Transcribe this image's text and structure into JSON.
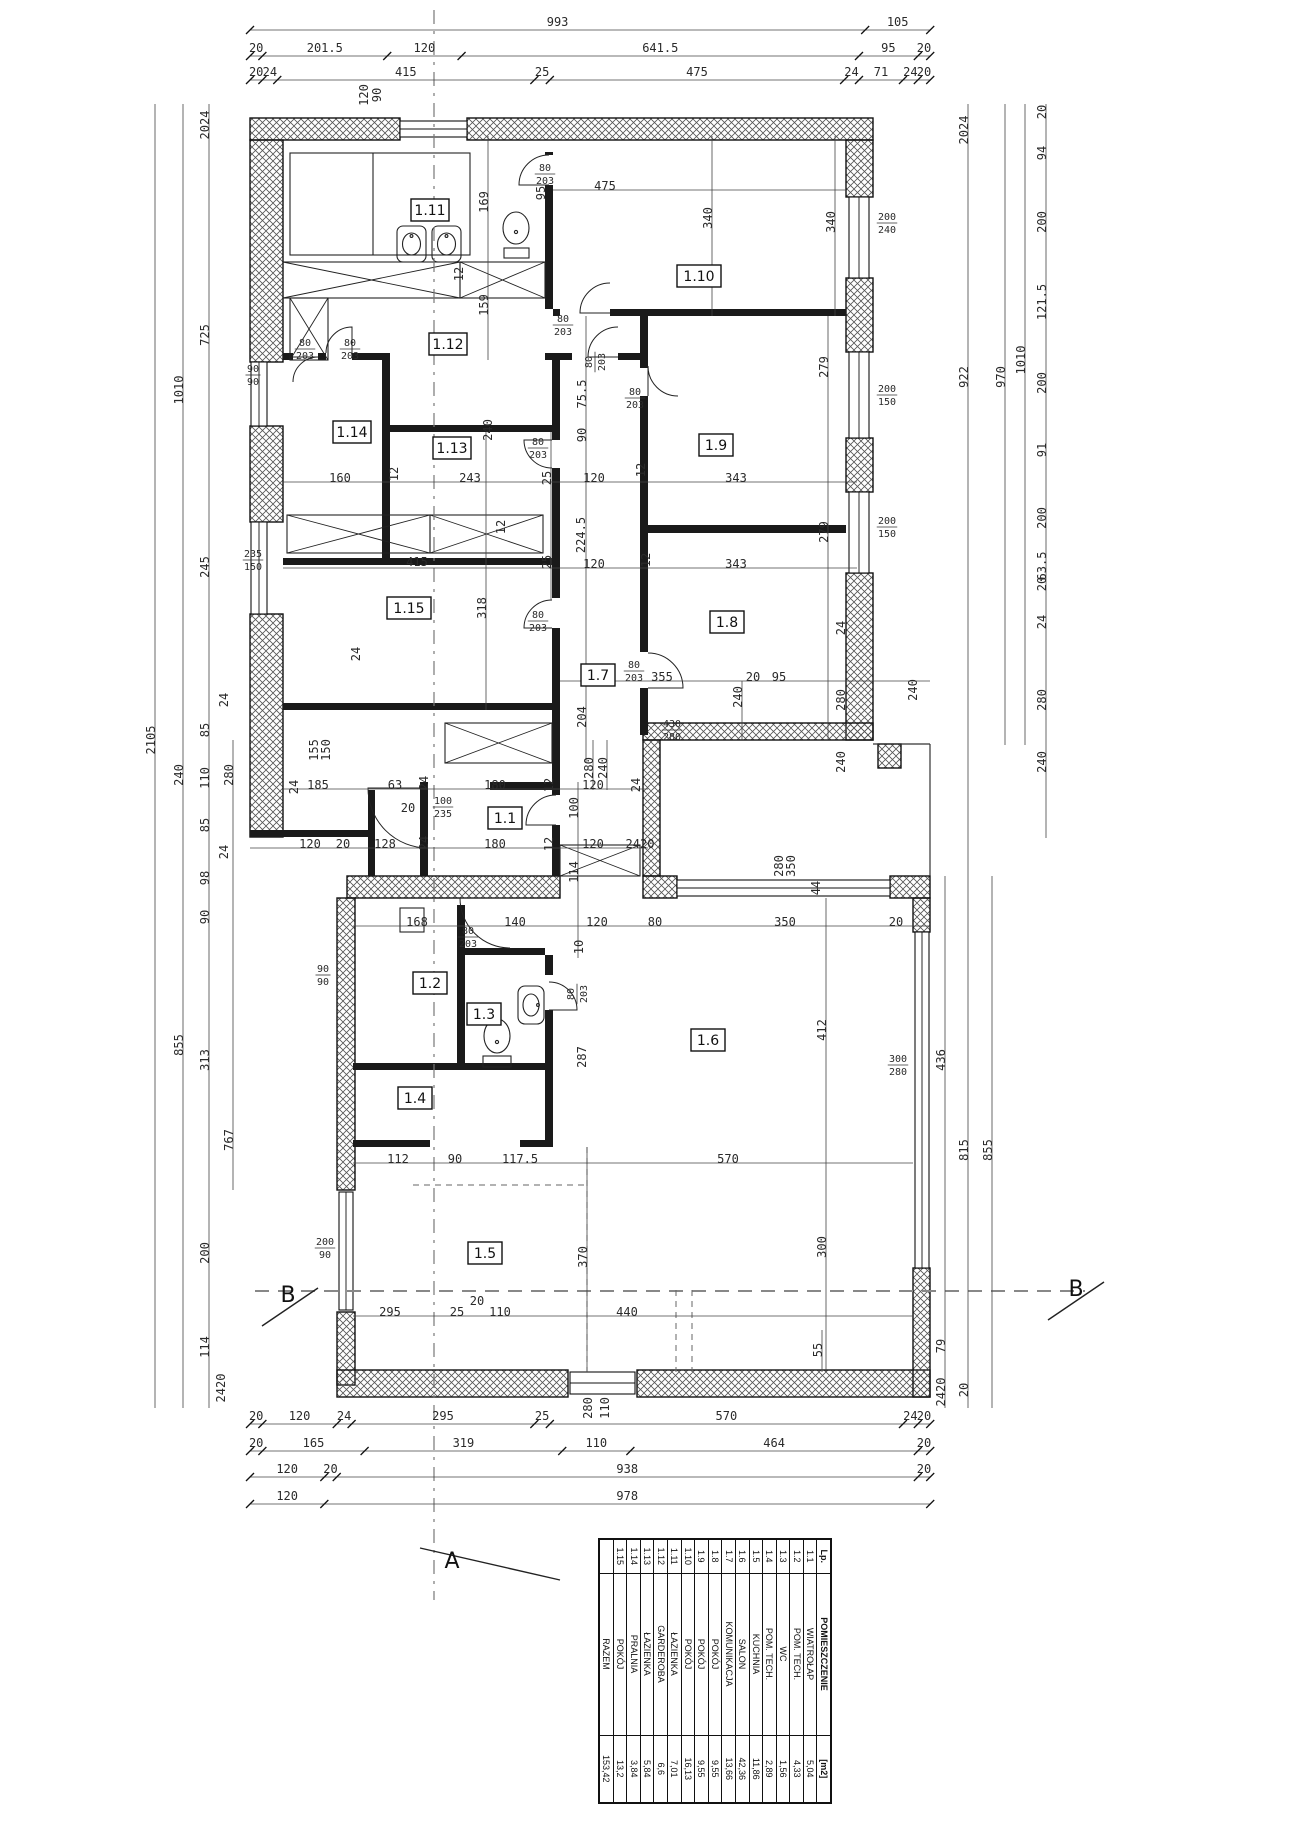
{
  "drawing": {
    "scale_px_per_cm": 0.6195,
    "origin_x": 250,
    "section_a_label": "A",
    "section_b_label": "B"
  },
  "table": {
    "headers": [
      "Lp.",
      "POMIESZCZENIE",
      "[m2]"
    ],
    "rows": [
      [
        "1.1",
        "WIATROŁAP",
        "5,04"
      ],
      [
        "1.2",
        "POM. TECH.",
        "4,33"
      ],
      [
        "1.3",
        "WC",
        "1,56"
      ],
      [
        "1.4",
        "POM. TECH.",
        "2,89"
      ],
      [
        "1.5",
        "KUCHNIA",
        "11,86"
      ],
      [
        "1.6",
        "SALON",
        "42,36"
      ],
      [
        "1.7",
        "KOMUNIKACJA",
        "13,66"
      ],
      [
        "1.8",
        "POKÓJ",
        "9,55"
      ],
      [
        "1.9",
        "POKÓJ",
        "9,55"
      ],
      [
        "1.10",
        "POKÓJ",
        "16,13"
      ],
      [
        "1.11",
        "ŁAZIENKA",
        "7,01"
      ],
      [
        "1.12",
        "GARDEROBA",
        "6,6"
      ],
      [
        "1.13",
        "ŁAZIENKA",
        "5,84"
      ],
      [
        "1.14",
        "PRALNIA",
        "3,84"
      ],
      [
        "1.15",
        "POKÓJ",
        "13,2"
      ]
    ],
    "total_row": [
      "",
      "RAZEM",
      "153,42"
    ]
  },
  "rooms": [
    [
      "1.11",
      430,
      210,
      38
    ],
    [
      "1.12",
      448,
      344,
      38
    ],
    [
      "1.14",
      352,
      432,
      38
    ],
    [
      "1.13",
      452,
      448,
      38
    ],
    [
      "1.10",
      699,
      276,
      44
    ],
    [
      "1.9",
      716,
      445,
      34
    ],
    [
      "1.8",
      727,
      622,
      34
    ],
    [
      "1.15",
      409,
      608,
      44
    ],
    [
      "1.7",
      598,
      675,
      34
    ],
    [
      "1.1",
      505,
      818,
      34
    ],
    [
      "1.2",
      430,
      983,
      34
    ],
    [
      "1.3",
      484,
      1014,
      34
    ],
    [
      "1.4",
      415,
      1098,
      34
    ],
    [
      "1.5",
      485,
      1253,
      34
    ],
    [
      "1.6",
      708,
      1040,
      34
    ]
  ],
  "dim_chains": [
    {
      "y": 30,
      "vals": [
        "993",
        "105"
      ]
    },
    {
      "y": 56,
      "vals": [
        "20",
        "201.5",
        "120",
        "641.5",
        "95",
        "20"
      ]
    },
    {
      "y": 80,
      "vals": [
        "20",
        "24",
        "415",
        "25",
        "475",
        "24",
        "71",
        "24",
        "20"
      ]
    },
    {
      "y": 1424,
      "vals": [
        "20",
        "120",
        "24",
        "295",
        "25",
        "570",
        "24",
        "20"
      ]
    },
    {
      "y": 1451,
      "vals": [
        "20",
        "165",
        "319",
        "110",
        "464",
        "20"
      ]
    },
    {
      "y": 1477,
      "vals": [
        "120",
        "20",
        "938",
        "20"
      ]
    },
    {
      "y": 1504,
      "vals": [
        "120",
        "978"
      ]
    }
  ],
  "annotations": [
    [
      "2105",
      155,
      740,
      1
    ],
    [
      "1010",
      183,
      390,
      1
    ],
    [
      "240",
      183,
      775,
      1
    ],
    [
      "855",
      183,
      1045,
      1
    ],
    [
      "2024",
      209,
      125,
      1
    ],
    [
      "725",
      209,
      335,
      1
    ],
    [
      "245",
      209,
      567,
      1
    ],
    [
      "24",
      228,
      700,
      1
    ],
    [
      "85",
      209,
      730,
      1
    ],
    [
      "110",
      209,
      778,
      1
    ],
    [
      "85",
      209,
      825,
      1
    ],
    [
      "24",
      228,
      852,
      1
    ],
    [
      "98",
      209,
      878,
      1
    ],
    [
      "90",
      209,
      917,
      1
    ],
    [
      "313",
      209,
      1060,
      1
    ],
    [
      "200",
      209,
      1253,
      1
    ],
    [
      "114",
      209,
      1347,
      1
    ],
    [
      "2420",
      225,
      1388,
      1
    ],
    [
      "280",
      233,
      775,
      1
    ],
    [
      "767",
      233,
      1140,
      1
    ],
    [
      "24",
      298,
      787,
      1
    ],
    [
      "24",
      360,
      654,
      1
    ],
    [
      "155",
      318,
      750,
      1
    ],
    [
      "150",
      330,
      750,
      1
    ],
    [
      "2024",
      968,
      130,
      1
    ],
    [
      "922",
      968,
      377,
      1
    ],
    [
      "815",
      968,
      1150,
      1
    ],
    [
      "20",
      968,
      1390,
      1
    ],
    [
      "970",
      1005,
      377,
      1
    ],
    [
      "1010",
      1025,
      360,
      1
    ],
    [
      "20",
      1046,
      112,
      1
    ],
    [
      "94",
      1046,
      153,
      1
    ],
    [
      "200",
      1046,
      222,
      1
    ],
    [
      "121.5",
      1046,
      302,
      1
    ],
    [
      "200",
      1046,
      383,
      1
    ],
    [
      "91",
      1046,
      450,
      1
    ],
    [
      "200",
      1046,
      518,
      1
    ],
    [
      "63.5",
      1046,
      566,
      1
    ],
    [
      "20",
      1046,
      584,
      1
    ],
    [
      "24",
      1046,
      622,
      1
    ],
    [
      "280",
      1046,
      700,
      1
    ],
    [
      "240",
      1046,
      762,
      1
    ],
    [
      "24",
      845,
      628,
      1
    ],
    [
      "280",
      845,
      700,
      1
    ],
    [
      "240",
      845,
      762,
      1
    ],
    [
      "436",
      945,
      1060,
      1
    ],
    [
      "79",
      945,
      1346,
      1
    ],
    [
      "2420",
      945,
      1392,
      1
    ],
    [
      "855",
      992,
      1150,
      1
    ],
    [
      "240",
      917,
      690,
      1
    ],
    [
      "44",
      820,
      888,
      1
    ],
    [
      "350",
      795,
      866,
      1
    ],
    [
      "280",
      783,
      866,
      1
    ],
    [
      "120",
      368,
      95,
      1
    ],
    [
      "90",
      381,
      95,
      1
    ],
    [
      "160",
      340,
      482,
      0
    ],
    [
      "12",
      398,
      474,
      1
    ],
    [
      "243",
      470,
      482,
      0
    ],
    [
      "25",
      551,
      478,
      1
    ],
    [
      "120",
      594,
      482,
      0
    ],
    [
      "12",
      645,
      470,
      1
    ],
    [
      "343",
      736,
      482,
      0
    ],
    [
      "415",
      417,
      566,
      0
    ],
    [
      "25",
      551,
      562,
      1
    ],
    [
      "120",
      594,
      568,
      0
    ],
    [
      "12",
      650,
      560,
      1
    ],
    [
      "343",
      736,
      568,
      0
    ],
    [
      "475",
      605,
      190,
      0
    ],
    [
      "340",
      712,
      218,
      1
    ],
    [
      "340",
      835,
      222,
      1
    ],
    [
      "279",
      828,
      367,
      1
    ],
    [
      "279",
      828,
      532,
      1
    ],
    [
      "169",
      488,
      202,
      1
    ],
    [
      "159",
      488,
      305,
      1
    ],
    [
      "12",
      463,
      274,
      1
    ],
    [
      "12",
      505,
      527,
      1
    ],
    [
      "240",
      492,
      430,
      1
    ],
    [
      "75.5",
      586,
      394,
      1
    ],
    [
      "90",
      586,
      435,
      1
    ],
    [
      "224.5",
      585,
      535,
      1
    ],
    [
      "204",
      586,
      717,
      1
    ],
    [
      "318",
      486,
      608,
      1
    ],
    [
      "95",
      545,
      193,
      1
    ],
    [
      "185",
      318,
      789,
      0
    ],
    [
      "63",
      395,
      789,
      0
    ],
    [
      "24",
      428,
      783,
      1
    ],
    [
      "180",
      495,
      789,
      0
    ],
    [
      "12",
      553,
      785,
      1
    ],
    [
      "120",
      593,
      789,
      0
    ],
    [
      "24",
      640,
      785,
      1
    ],
    [
      "120",
      310,
      848,
      0
    ],
    [
      "20",
      343,
      848,
      0
    ],
    [
      "128",
      385,
      848,
      0
    ],
    [
      "24",
      428,
      843,
      1
    ],
    [
      "180",
      495,
      848,
      0
    ],
    [
      "12",
      553,
      844,
      1
    ],
    [
      "120",
      593,
      848,
      0
    ],
    [
      "2420",
      640,
      848,
      0
    ],
    [
      "20",
      408,
      812,
      0
    ],
    [
      "100",
      578,
      808,
      1
    ],
    [
      "114",
      578,
      872,
      1
    ],
    [
      "280",
      593,
      768,
      1
    ],
    [
      "240",
      607,
      768,
      1
    ],
    [
      "168",
      417,
      926,
      0
    ],
    [
      "140",
      515,
      926,
      0
    ],
    [
      "120",
      597,
      926,
      0
    ],
    [
      "80",
      655,
      926,
      0
    ],
    [
      "350",
      785,
      926,
      0
    ],
    [
      "20",
      896,
      926,
      0
    ],
    [
      "10",
      583,
      947,
      1
    ],
    [
      "287",
      586,
      1057,
      1
    ],
    [
      "412",
      826,
      1030,
      1
    ],
    [
      "355",
      662,
      681,
      0
    ],
    [
      "240",
      742,
      697,
      1
    ],
    [
      "20",
      753,
      681,
      0
    ],
    [
      "95",
      779,
      681,
      0
    ],
    [
      "112",
      398,
      1163,
      0
    ],
    [
      "90",
      455,
      1163,
      0
    ],
    [
      "117.5",
      520,
      1163,
      0
    ],
    [
      "570",
      728,
      1163,
      0
    ],
    [
      "295",
      390,
      1316,
      0
    ],
    [
      "25",
      457,
      1316,
      0
    ],
    [
      "20",
      477,
      1305,
      0
    ],
    [
      "110",
      500,
      1316,
      0
    ],
    [
      "440",
      627,
      1316,
      0
    ],
    [
      "55",
      822,
      1350,
      1
    ],
    [
      "370",
      587,
      1257,
      1
    ],
    [
      "300",
      826,
      1247,
      1
    ],
    [
      "280",
      592,
      1408,
      1
    ],
    [
      "110",
      609,
      1408,
      1
    ]
  ],
  "fractions": [
    [
      "90",
      "90",
      253,
      372,
      0
    ],
    [
      "235",
      "150",
      253,
      557,
      0
    ],
    [
      "90",
      "90",
      323,
      972,
      0
    ],
    [
      "200",
      "90",
      325,
      1245,
      0
    ],
    [
      "200",
      "240",
      887,
      220,
      0
    ],
    [
      "200",
      "150",
      887,
      392,
      0
    ],
    [
      "200",
      "150",
      887,
      524,
      0
    ],
    [
      "80",
      "203",
      545,
      171,
      0
    ],
    [
      "80",
      "203",
      563,
      322,
      0
    ],
    [
      "80",
      "203",
      596,
      358,
      1
    ],
    [
      "80",
      "203",
      635,
      395,
      0
    ],
    [
      "80",
      "203",
      305,
      346,
      0
    ],
    [
      "80",
      "203",
      350,
      346,
      0
    ],
    [
      "80",
      "203",
      538,
      445,
      0
    ],
    [
      "80",
      "203",
      538,
      618,
      0
    ],
    [
      "80",
      "203",
      634,
      668,
      0
    ],
    [
      "80",
      "203",
      468,
      934,
      0
    ],
    [
      "80",
      "203",
      578,
      990,
      1
    ],
    [
      "100",
      "235",
      443,
      804,
      0
    ],
    [
      "430",
      "280",
      672,
      727,
      0
    ],
    [
      "300",
      "280",
      898,
      1062,
      0
    ]
  ],
  "dim_lines": [
    [
      155,
      104,
      155,
      1408
    ],
    [
      183,
      104,
      183,
      1408
    ],
    [
      209,
      104,
      209,
      1408
    ],
    [
      233,
      740,
      233,
      1190
    ],
    [
      968,
      104,
      968,
      1408
    ],
    [
      1005,
      104,
      1005,
      745
    ],
    [
      1025,
      104,
      1025,
      745
    ],
    [
      1046,
      104,
      1046,
      838
    ],
    [
      945,
      876,
      945,
      1408
    ],
    [
      992,
      876,
      992,
      1408
    ],
    [
      488,
      136,
      488,
      360
    ],
    [
      486,
      432,
      486,
      710
    ],
    [
      586,
      316,
      586,
      762
    ],
    [
      578,
      782,
      578,
      958
    ],
    [
      826,
      898,
      826,
      1372
    ],
    [
      587,
      1147,
      587,
      1372
    ],
    [
      828,
      316,
      828,
      740
    ],
    [
      835,
      136,
      835,
      316
    ],
    [
      712,
      136,
      712,
      316
    ],
    [
      551,
      432,
      551,
      600
    ],
    [
      742,
      681,
      742,
      740
    ],
    [
      822,
      1330,
      822,
      1372
    ],
    [
      593,
      740,
      593,
      790
    ],
    [
      607,
      740,
      607,
      790
    ],
    [
      283,
      482,
      857,
      482
    ],
    [
      283,
      568,
      857,
      568
    ],
    [
      553,
      190,
      846,
      190
    ],
    [
      560,
      681,
      930,
      681
    ],
    [
      283,
      789,
      648,
      789
    ],
    [
      250,
      848,
      648,
      848
    ],
    [
      353,
      926,
      930,
      926
    ],
    [
      353,
      1163,
      913,
      1163
    ],
    [
      353,
      1316,
      913,
      1316
    ]
  ],
  "markers": [
    {
      "label": "A",
      "x": 452,
      "y": 1568,
      "lx1": 420,
      "ly1": 1548,
      "lx2": 560,
      "ly2": 1580
    },
    {
      "label": "B",
      "x": 288,
      "y": 1302,
      "lx1": 262,
      "ly1": 1326,
      "lx2": 318,
      "ly2": 1288
    },
    {
      "label": "B",
      "x": 1076,
      "y": 1296,
      "lx1": 1048,
      "ly1": 1320,
      "lx2": 1104,
      "ly2": 1282
    }
  ]
}
